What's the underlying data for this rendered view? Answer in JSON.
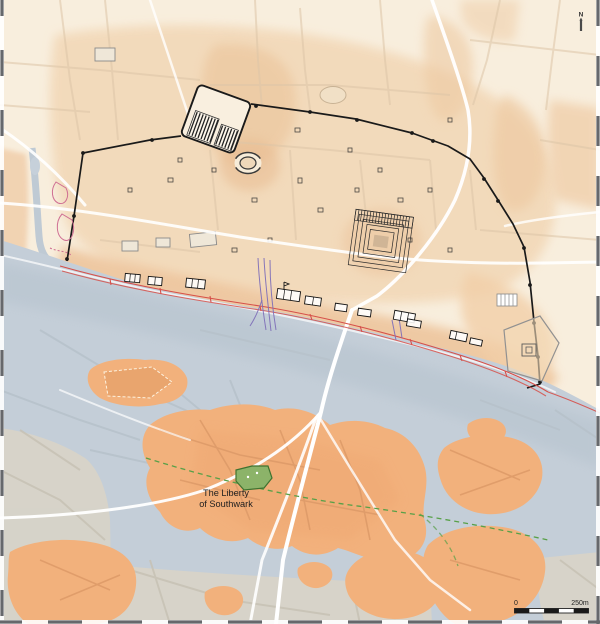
{
  "map": {
    "region_labels": {
      "liberty_line1": "The Liberty",
      "liberty_line2": "of Southwark"
    },
    "north_arrow": {
      "label": "N"
    },
    "scale_bar": {
      "start": "0",
      "end": "250m"
    }
  },
  "colors": {
    "c-land-cream": "#f8eedd",
    "c-terrain-peach": "#f2d7b6",
    "c-terrain-orange": "#edc39a",
    "c-river": "#c4ced8",
    "c-island-orange": "#f2b17c",
    "c-island-street": "#dd9a68",
    "c-modern-gray": "#d8d4c8",
    "c-wall-black": "#1a1a1a",
    "c-revetment-red": "#d6504a",
    "c-stream-purple": "#8070b8",
    "c-site-green": "#8cb369",
    "c-site-green-dark": "#3f7230",
    "c-boundary-green": "#58a048",
    "c-road-white": "#ffffff",
    "c-label-dark": "#1f1f1f",
    "c-border-dash": "#66686c"
  }
}
